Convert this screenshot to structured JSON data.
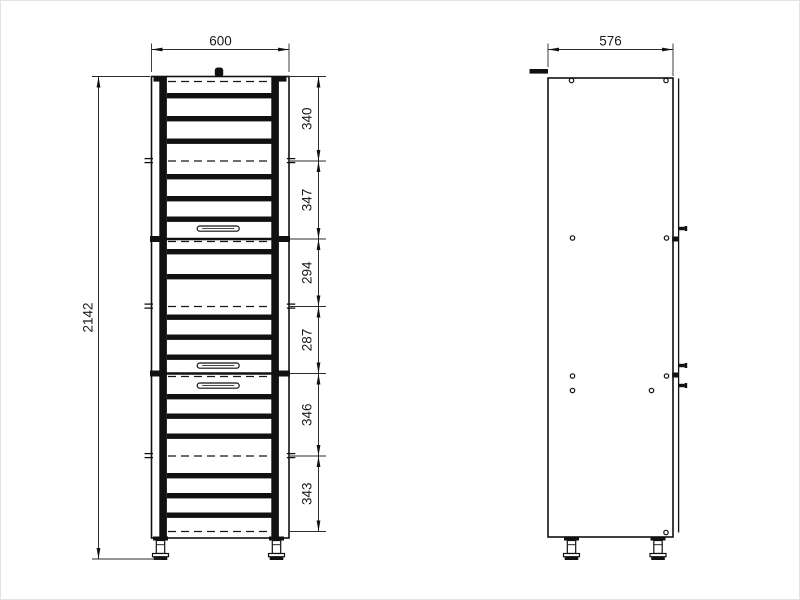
{
  "front_view": {
    "width": "600",
    "overall_height": "2142",
    "section_heights": [
      "340",
      "347",
      "294",
      "287",
      "346",
      "343"
    ]
  },
  "side_view": {
    "depth": "576"
  },
  "colors": {
    "line": "#111111",
    "dimension": "#2b2b2b",
    "background": "#ffffff"
  }
}
